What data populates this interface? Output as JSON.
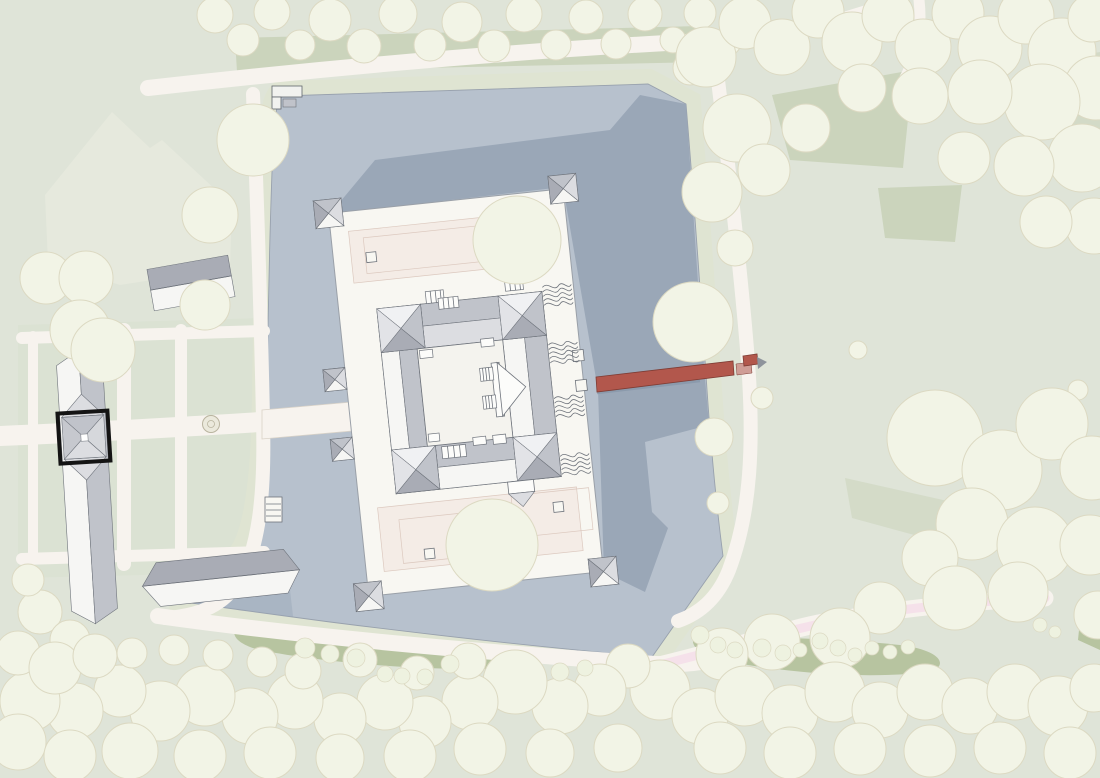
{
  "plan": {
    "kind": "site-plan",
    "visible_text": "none",
    "highlight_marker": {
      "shape": "square-outline",
      "color": "#141414"
    }
  },
  "colors": {
    "ground": "#dfe4d8",
    "ground_light": "#e6e9dd",
    "lawn_dark": "#cbd4bc",
    "shrub": "#b7c4a0",
    "parterre": "#dbe2d3",
    "path": "#f7f3ee",
    "pink_path": "#f5e1ea",
    "water": "#b7c1cd",
    "water_shadow": "#9aa7b7",
    "shore_line": "#98a1ad",
    "berm": "#dfe4d2",
    "tree_fill": "#f2f4e6",
    "tree_stroke": "#dcd9c2",
    "bush_fill": "#eef2e0",
    "platform": "#f8f7f2",
    "wall": "#fcfcfa",
    "courtyard": "#f4f3ee",
    "terrace": "#f4ece6",
    "terrace_line": "#dcc9bf",
    "roof_white": "#f6f6f4",
    "roof_pale": "#e9eaec",
    "roof_light": "#dcdde1",
    "roof_mid": "#c0c3ca",
    "roof_dark": "#a9acb5",
    "line": "#6f747c",
    "line_light": "#9aa0a8",
    "bridge": "#b2574c",
    "bridge_dark": "#7e3c34",
    "bridge_light": "#cf9d96",
    "steel": "#8e939b",
    "highlight": "#141414",
    "fountain_fill": "#ebe9dc",
    "fountain_line": "#b9b49f",
    "blob": "#9aa492"
  },
  "trees": {
    "top_band": [
      [
        215,
        15,
        18
      ],
      [
        243,
        40,
        16
      ],
      [
        272,
        12,
        18
      ],
      [
        300,
        45,
        15
      ],
      [
        330,
        20,
        21
      ],
      [
        364,
        46,
        17
      ],
      [
        398,
        14,
        19
      ],
      [
        430,
        45,
        16
      ],
      [
        462,
        22,
        20
      ],
      [
        494,
        46,
        16
      ],
      [
        524,
        14,
        18
      ],
      [
        556,
        45,
        15
      ],
      [
        586,
        17,
        17
      ],
      [
        616,
        44,
        15
      ],
      [
        645,
        14,
        17
      ],
      [
        673,
        40,
        13
      ],
      [
        700,
        13,
        16
      ],
      [
        727,
        42,
        14
      ],
      [
        752,
        18,
        15
      ],
      [
        690,
        68,
        17
      ]
    ],
    "top_right": [
      [
        706,
        57,
        30
      ],
      [
        745,
        23,
        26
      ],
      [
        782,
        47,
        28
      ],
      [
        818,
        12,
        26
      ],
      [
        852,
        42,
        30
      ],
      [
        888,
        16,
        26
      ],
      [
        923,
        47,
        28
      ],
      [
        958,
        13,
        26
      ],
      [
        990,
        48,
        32
      ],
      [
        1026,
        16,
        28
      ],
      [
        1062,
        52,
        34
      ],
      [
        1092,
        18,
        24
      ],
      [
        1096,
        88,
        32
      ],
      [
        1042,
        102,
        38
      ],
      [
        980,
        92,
        32
      ],
      [
        920,
        96,
        28
      ],
      [
        862,
        88,
        24
      ],
      [
        737,
        128,
        34
      ],
      [
        712,
        192,
        30
      ],
      [
        764,
        170,
        26
      ],
      [
        806,
        128,
        24
      ],
      [
        1082,
        158,
        34
      ],
      [
        1024,
        166,
        30
      ],
      [
        964,
        158,
        26
      ],
      [
        1094,
        226,
        28
      ],
      [
        1046,
        222,
        26
      ],
      [
        735,
        248,
        18
      ]
    ],
    "east_shore": [
      [
        693,
        322,
        40
      ],
      [
        714,
        437,
        19
      ],
      [
        718,
        503,
        11
      ],
      [
        762,
        398,
        11
      ],
      [
        858,
        350,
        9
      ],
      [
        1078,
        390,
        10
      ]
    ],
    "right_mid": [
      [
        935,
        438,
        48
      ],
      [
        1002,
        470,
        40
      ],
      [
        1052,
        424,
        36
      ],
      [
        1092,
        468,
        32
      ],
      [
        972,
        524,
        36
      ],
      [
        1035,
        545,
        38
      ],
      [
        930,
        558,
        28
      ],
      [
        1090,
        545,
        30
      ],
      [
        955,
        598,
        32
      ],
      [
        1018,
        592,
        30
      ],
      [
        880,
        608,
        26
      ],
      [
        1098,
        615,
        24
      ]
    ],
    "bottom": [
      [
        840,
        638,
        30
      ],
      [
        772,
        642,
        28
      ],
      [
        722,
        654,
        26
      ],
      [
        660,
        690,
        30
      ],
      [
        700,
        716,
        28
      ],
      [
        745,
        696,
        30
      ],
      [
        790,
        713,
        28
      ],
      [
        835,
        692,
        30
      ],
      [
        880,
        710,
        28
      ],
      [
        925,
        692,
        28
      ],
      [
        970,
        706,
        28
      ],
      [
        1015,
        692,
        28
      ],
      [
        1058,
        706,
        30
      ],
      [
        1094,
        688,
        24
      ],
      [
        720,
        748,
        26
      ],
      [
        790,
        753,
        26
      ],
      [
        860,
        749,
        26
      ],
      [
        930,
        751,
        26
      ],
      [
        1000,
        748,
        26
      ],
      [
        1070,
        753,
        26
      ],
      [
        628,
        666,
        22
      ],
      [
        600,
        690,
        26
      ],
      [
        560,
        706,
        28
      ],
      [
        515,
        682,
        32
      ],
      [
        470,
        702,
        28
      ],
      [
        425,
        722,
        26
      ],
      [
        385,
        702,
        28
      ],
      [
        340,
        719,
        26
      ],
      [
        295,
        701,
        28
      ],
      [
        250,
        716,
        28
      ],
      [
        205,
        696,
        30
      ],
      [
        160,
        711,
        30
      ],
      [
        120,
        691,
        26
      ],
      [
        75,
        711,
        28
      ],
      [
        30,
        701,
        30
      ],
      [
        18,
        653,
        22
      ],
      [
        55,
        668,
        26
      ],
      [
        95,
        656,
        22
      ],
      [
        18,
        742,
        28
      ],
      [
        70,
        756,
        26
      ],
      [
        130,
        751,
        28
      ],
      [
        200,
        756,
        26
      ],
      [
        270,
        753,
        26
      ],
      [
        340,
        758,
        24
      ],
      [
        410,
        756,
        26
      ],
      [
        480,
        749,
        26
      ],
      [
        550,
        753,
        24
      ],
      [
        618,
        748,
        24
      ],
      [
        303,
        671,
        18
      ],
      [
        360,
        660,
        17
      ],
      [
        417,
        673,
        17
      ],
      [
        468,
        661,
        18
      ],
      [
        262,
        662,
        15
      ],
      [
        218,
        655,
        15
      ],
      [
        174,
        650,
        15
      ],
      [
        132,
        653,
        15
      ]
    ],
    "garden": [
      [
        253,
        140,
        36
      ],
      [
        210,
        215,
        28
      ],
      [
        46,
        278,
        26
      ],
      [
        86,
        278,
        27
      ],
      [
        205,
        305,
        25
      ],
      [
        80,
        330,
        30
      ],
      [
        103,
        350,
        32
      ],
      [
        40,
        612,
        22
      ],
      [
        70,
        640,
        20
      ],
      [
        28,
        580,
        16
      ]
    ],
    "platform": [
      [
        517,
        240,
        44
      ],
      [
        492,
        545,
        46
      ]
    ]
  },
  "bushes": [
    [
      305,
      648,
      10
    ],
    [
      330,
      654,
      9
    ],
    [
      356,
      658,
      9
    ],
    [
      385,
      674,
      8
    ],
    [
      402,
      676,
      8
    ],
    [
      425,
      677,
      8
    ],
    [
      450,
      664,
      9
    ],
    [
      560,
      672,
      9
    ],
    [
      585,
      668,
      8
    ],
    [
      700,
      635,
      9
    ],
    [
      718,
      645,
      8
    ],
    [
      735,
      650,
      8
    ],
    [
      762,
      648,
      9
    ],
    [
      783,
      653,
      8
    ],
    [
      800,
      650,
      7
    ],
    [
      820,
      641,
      8
    ],
    [
      838,
      648,
      8
    ],
    [
      855,
      655,
      7
    ],
    [
      872,
      648,
      7
    ],
    [
      890,
      652,
      7
    ],
    [
      908,
      647,
      7
    ],
    [
      1040,
      625,
      7
    ],
    [
      1055,
      632,
      6
    ]
  ]
}
